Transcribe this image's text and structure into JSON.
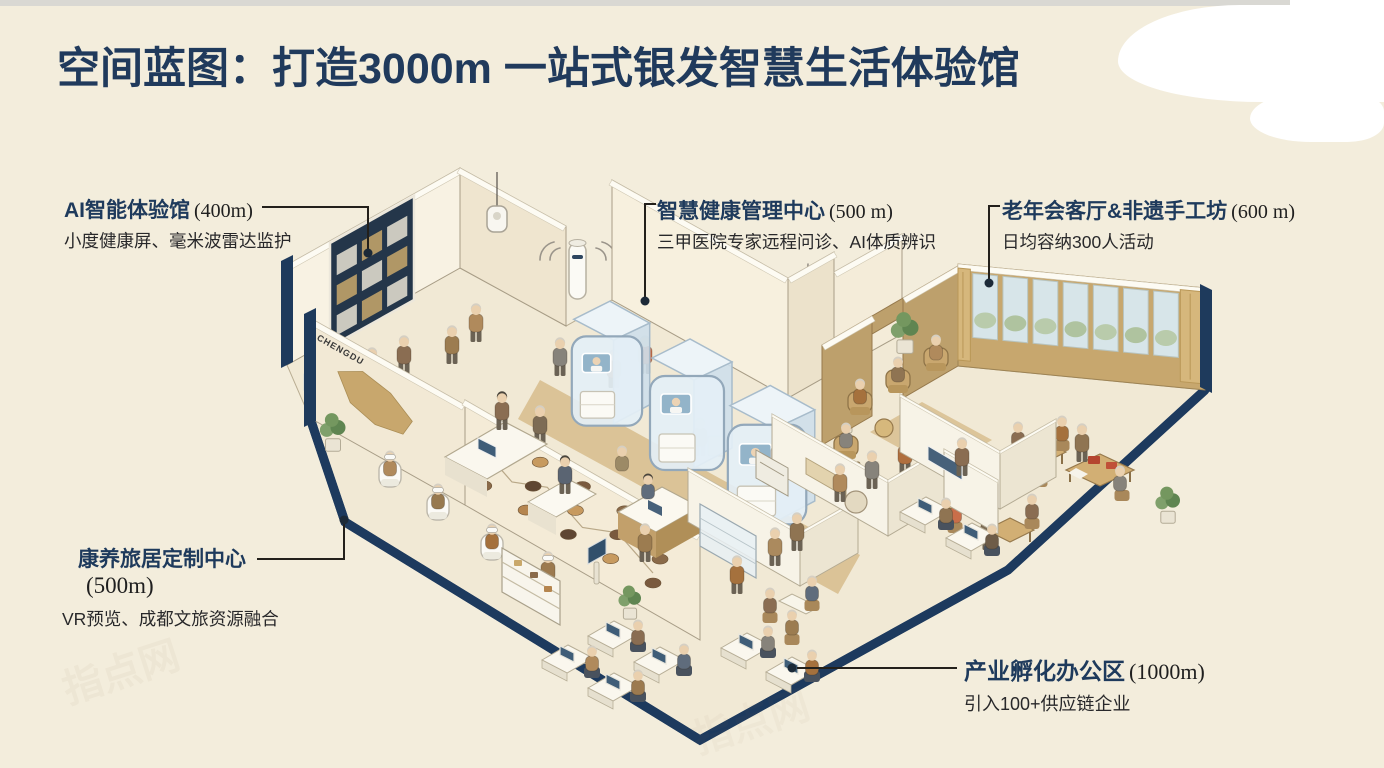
{
  "page": {
    "title": "空间蓝图：打造3000m 一站式银发智慧生活体验馆",
    "background": "#f3eddc"
  },
  "callouts": [
    {
      "name": "AI智能体验馆",
      "area": "(400m)",
      "desc": "小度健康屏、毫米波雷达监护"
    },
    {
      "name": "智慧健康管理中心",
      "area": "(500 m)",
      "desc": "三甲医院专家远程问诊、AI体质辨识"
    },
    {
      "name": "老年会客厅&非遗手工坊",
      "area": "(600 m)",
      "desc": "日均容纳300人活动"
    },
    {
      "name": "康养旅居定制中心",
      "area": "(500m)",
      "desc": "VR预览、成都文旅资源融合"
    },
    {
      "name": "产业孵化办公区",
      "area": "(1000m)",
      "desc": "引入100+供应链企业"
    }
  ],
  "illustration": {
    "map_label": "CHENGDU"
  },
  "watermark": {
    "text": "指点网"
  },
  "colors": {
    "navy": "#1e3a5c",
    "rim": "#1d3a5e",
    "tan_wall": "#c7a76e",
    "wall_cream": "#f7f0de",
    "floor": "#f1e9d5",
    "glass": "#e4eff6",
    "line": "#23201b"
  }
}
